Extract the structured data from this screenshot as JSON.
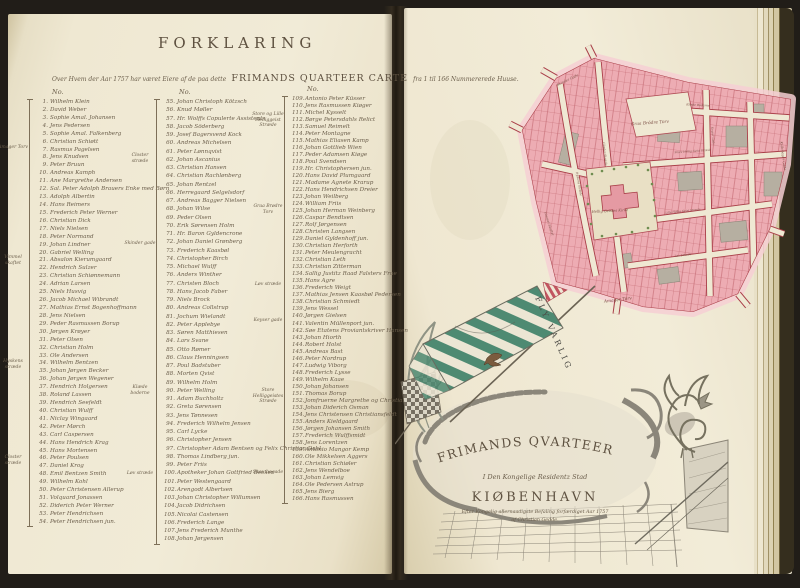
{
  "colors": {
    "ink": "#5e5140",
    "ink2": "#6a5d4a",
    "paper": "#efe8d3",
    "map_pink": "#edacb3",
    "map_pink_light": "#f6cfd3",
    "map_red": "#a93e48",
    "map_gray": "#b6afa1",
    "banner_green": "#4e8a72",
    "tree_green": "#6f8d50",
    "wash": "#8b867a"
  },
  "header": {
    "title": "FORKLARING",
    "subtitle_prefix": "Over Hvem der Aar 1757 har været Eiere af de paa dette",
    "subtitle_emphasis": "FRIMANDS QUARTEER CARTE",
    "subtitle_suffix": "fra 1 til 166 Nummererede Huuse."
  },
  "columns": [
    {
      "header": "No.",
      "start": 1,
      "line_height": 7.93,
      "margin_labels": [
        {
          "text": "Amager Torv",
          "top": 46
        },
        {
          "text": "Vimmel skaftet",
          "top": 156
        },
        {
          "text": "Hyskens stræde",
          "top": 260
        },
        {
          "text": "Closter stræde",
          "top": 356
        }
      ],
      "names": [
        "Wilhelm Klein",
        "David Weber",
        "Sophie Amal. Johansen",
        "Jens Pedersen",
        "Sophie Amal. Falkenberg",
        "Christian Schiøtt",
        "Rasmus Pagelsen",
        "Jens Knudsen",
        "Peter Bruun",
        "Andreas Kamph",
        "Ane Margrethe Andersen",
        "Sal. Peter Adolph Brauers Enke med Børn",
        "Adolph Albertin",
        "Hans Reimers",
        "Frederich Peter Werner",
        "Christian Dick",
        "Niels Nielsen",
        "Peter Normand",
        "Johan Lindner",
        "Gabriel Welling",
        "Absalon Kierumgaard",
        "Hendrich Sulzer",
        "Christian Schiønnemann",
        "Adrian Larsen",
        "Niels Husvig",
        "Jacob Michael Wibrandt",
        "Mathias Ernst Bogenhoffmann",
        "Jens Nielsen",
        "Peder Rasmussen Borup",
        "Jørgen Krøyer",
        "Peter Olsen",
        "Christian Holm",
        "Ole Andersen",
        "Wilhelm Bentzen",
        "Johan Jørgen Becker",
        "Johan Jørgen Wegener",
        "Hendrich Holgersen",
        "Roland Lassen",
        "Hendrich Seefeldt",
        "Christian Wulff",
        "Niclay Wingaard",
        "Peter Mørch",
        "Carl Caspersen",
        "Hans Hendrich Krag",
        "Hans Mortensen",
        "Peter Poulsen",
        "Daniel Krog",
        "Emil Bentzen Smith",
        "Wilhelm Kohl",
        "Peter Christensen Allerup",
        "Volquard Jonassen",
        "Diderich Peter Werner",
        "Peter Hendrichsen",
        "Peter Hendrichsen jun."
      ]
    },
    {
      "header": "No.",
      "start": 55,
      "line_height": 8.26,
      "margin_labels": [
        {
          "text": "Closter stræde",
          "top": 54
        },
        {
          "text": "Skinder gade",
          "top": 142
        },
        {
          "text": "Klæde boderne",
          "top": 286
        },
        {
          "text": "Løv stræde",
          "top": 372
        }
      ],
      "names": [
        "Johan Christoph Kötzsch",
        "Knud Møller",
        "Hr. Wolffs Copulerte Assistents",
        "Jacob Söderberg",
        "Josef Bagersvend Kock",
        "Andreas Michelsen",
        "Peter Lønnqvist",
        "Johan Ascanius",
        "Christian Hansen",
        "Christian Rachlønberg",
        "Johan Rentzel",
        "Herregaard Selgelsdorf",
        "Andreas Bagger Nielsen",
        "Johan Wilse",
        "Peder Olsen",
        "Erik Sørensen Holm",
        "Hr. Baron Gyldencrone",
        "Johan Daniel Grønberg",
        "Frederich Kaasbøl",
        "Christopher Birch",
        "Michael Wulff",
        "Anders Winther",
        "Christen Bloch",
        "Hans Jacob Faber",
        "Niels Brock",
        "Andreas Collstrup",
        "Jochum Wielandt",
        "Peter Applebye",
        "Søren Matthiesen",
        "Lars Svane",
        "Otto Rømer",
        "Claus Henningsen",
        "Poul Badstuber",
        "Morten Qvist",
        "Wilhelm Holm",
        "Peter Welling",
        "Adam Buchholtz",
        "Greta Sørensen",
        "Jens Tønnesen",
        "Frederich Wilhelm Jensen",
        "Carl Lycke",
        "Christopher Jensen",
        "Christopher Adam Bentsen og Felix Christian Dahl",
        "Thomas Lindberg jun.",
        "Peter Friis",
        "Apotheker Johan Gottfried Becker",
        "Peter Westengaard",
        "Arengodt Albertsen",
        "Johan Christopher Willumsen",
        "Jacob Didrichsen",
        "Nicolai Castensen",
        "Frederich Lange",
        "Jens Frederich Munthe",
        "Johan Jørgensen"
      ]
    },
    {
      "header": "No.",
      "start": 109,
      "line_height": 7.03,
      "margin_labels": [
        {
          "text": "Store og Lille Helliggeist Stræde",
          "top": 16
        },
        {
          "text": "Graa Brødre Torv",
          "top": 108
        },
        {
          "text": "Løv stræde",
          "top": 186
        },
        {
          "text": "Keyser gade",
          "top": 222
        },
        {
          "text": "Store Helliggeistes Stræde",
          "top": 292
        },
        {
          "text": "Skou bogade",
          "top": 374
        }
      ],
      "names": [
        "Antonio Peter Küsser",
        "Jens Rasmussen Kiøger",
        "Michel Kysselt",
        "Børge Petersdahls Relict",
        "Samuel Reimelt",
        "Peter Montagne",
        "Mathias Eliasen Kamp",
        "Johan Gottlieb Wien",
        "Peder Adamsen Kiøge",
        "Poul Svendsen",
        "Hr. Christophersen jun.",
        "Hans David Plumgaard",
        "Madame Agnete Krarup",
        "Hans Hendrichsen Dreier",
        "Johan Weilberg",
        "William Friis",
        "Johan Herman Weinberg",
        "Caspar Bendtsen",
        "Rolf Jørgensen",
        "Christen Langsen",
        "Daniel Gyldenhoff jun.",
        "Christian Herforth",
        "Peter Meulengracht",
        "Christian Leth",
        "Christian Zitterman",
        "Sallig Justitz Raad Falsters Frue",
        "Hans Agre",
        "Frederich Weigt",
        "Mathias Jensen Kaasbøl Pedersen",
        "Christian Schmiedt",
        "Jens Wessel",
        "Jørgen Gielsen",
        "Valentin Müllenport jun.",
        "Søe Etatens Proviantskriver Hansen",
        "Johan Hiorth",
        "Robert Holst",
        "Andreas Bast",
        "Peter Nordrup",
        "Ludwig Viborg",
        "Frederich Lysse",
        "Wilhelm Kaae",
        "Johan Johansen",
        "Thomas Borup",
        "Jomfruerne Margrethe og Christiane Bartram",
        "Johan Diderich Osman",
        "Jens Christensen Christiansfeldt",
        "Anders Kieldgaard",
        "Jørgen Johansen Smith",
        "Frederich Wulffsmidt",
        "Jens Lorentzen",
        "Antonio Mangor Kemp",
        "Ole Mikkelsen Aggers",
        "Christian Schiøler",
        "Jens Wendelboe",
        "Johan Lemvig",
        "Ole Pedersen Astrup",
        "Jens Bierg",
        "Hans Rasmussen"
      ]
    }
  ],
  "map": {
    "labels": [
      {
        "text": "Graa Brödre Torv",
        "x": 152,
        "y": 80,
        "r": -4,
        "s": 4.3
      },
      {
        "text": "Hellig Geistes Kirke",
        "x": 112,
        "y": 168,
        "r": -3,
        "s": 3.6
      },
      {
        "text": "Amager Torv",
        "x": 120,
        "y": 257,
        "r": -7,
        "s": 4.3
      },
      {
        "text": "Kiöbmager Gade",
        "x": 284,
        "y": 112,
        "r": 83,
        "s": 3.4
      },
      {
        "text": "Skinder Gade",
        "x": 70,
        "y": 37,
        "r": -26,
        "s": 3.4
      },
      {
        "text": "Klæde Boderne",
        "x": 200,
        "y": 62,
        "r": 3,
        "s": 3
      },
      {
        "text": "Closter Stræde",
        "x": 106,
        "y": 110,
        "r": 84,
        "s": 3
      },
      {
        "text": "Hyskens Stræde",
        "x": 80,
        "y": 140,
        "r": 80,
        "s": 2.9
      },
      {
        "text": "Store Hellig Geist Stræde",
        "x": 195,
        "y": 108,
        "r": -4,
        "s": 2.8
      },
      {
        "text": "Lille Hellig Geist Stræde",
        "x": 185,
        "y": 168,
        "r": -6,
        "s": 2.8
      },
      {
        "text": "Løv Stræde",
        "x": 185,
        "y": 212,
        "r": -7,
        "s": 2.9
      },
      {
        "text": "Vimmel Skaftet",
        "x": 50,
        "y": 180,
        "r": 72,
        "s": 3.2
      },
      {
        "text": "Keyser Gade",
        "x": 214,
        "y": 92,
        "r": 85,
        "s": 2.8
      }
    ]
  },
  "cartouche": {
    "motto": "FLY VARLIG",
    "title": "FRIMANDS QVARTEER",
    "line2": "I Den Kongelige Residentz Stad",
    "city": "KIØBENHAVN",
    "credit1": "Efter Kongelig allernaadigste Befaling forfærdiget Aar 1757",
    "credit2": "af Christian Gedde."
  }
}
